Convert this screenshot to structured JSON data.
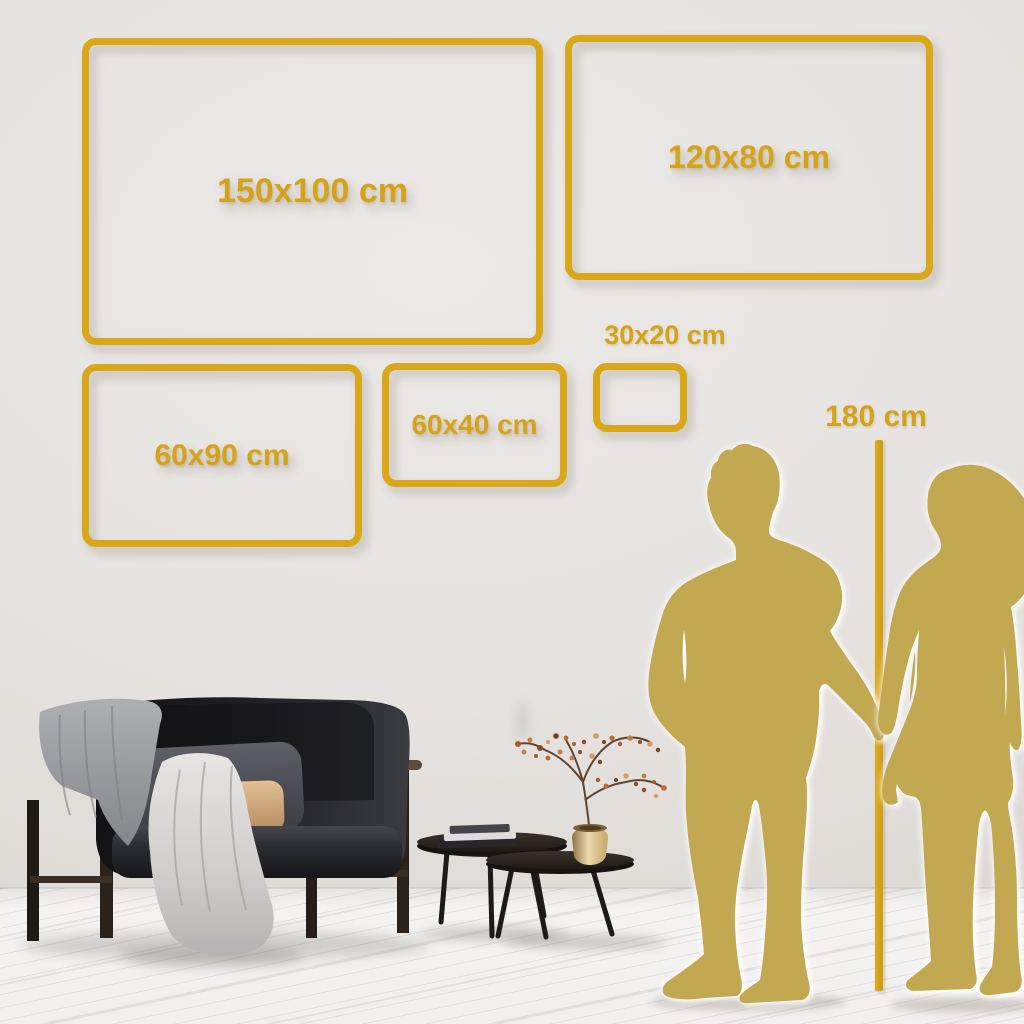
{
  "size_chart": {
    "frames": [
      {
        "label": "150x100 cm",
        "width_cm": 150,
        "height_cm": 100
      },
      {
        "label": "120x80 cm",
        "width_cm": 120,
        "height_cm": 80
      },
      {
        "label": "60x90 cm",
        "width_cm": 60,
        "height_cm": 90
      },
      {
        "label": "60x40 cm",
        "width_cm": 60,
        "height_cm": 40
      },
      {
        "label": "30x20 cm",
        "width_cm": 30,
        "height_cm": 20
      }
    ],
    "height_marker": {
      "label": "180 cm",
      "height_cm": 180
    }
  },
  "colors": {
    "accent_gold": "#D9A717",
    "silhouette_gold": "#C2A851",
    "wall": "#E6E3E0",
    "floor": "#F1F0EE"
  }
}
